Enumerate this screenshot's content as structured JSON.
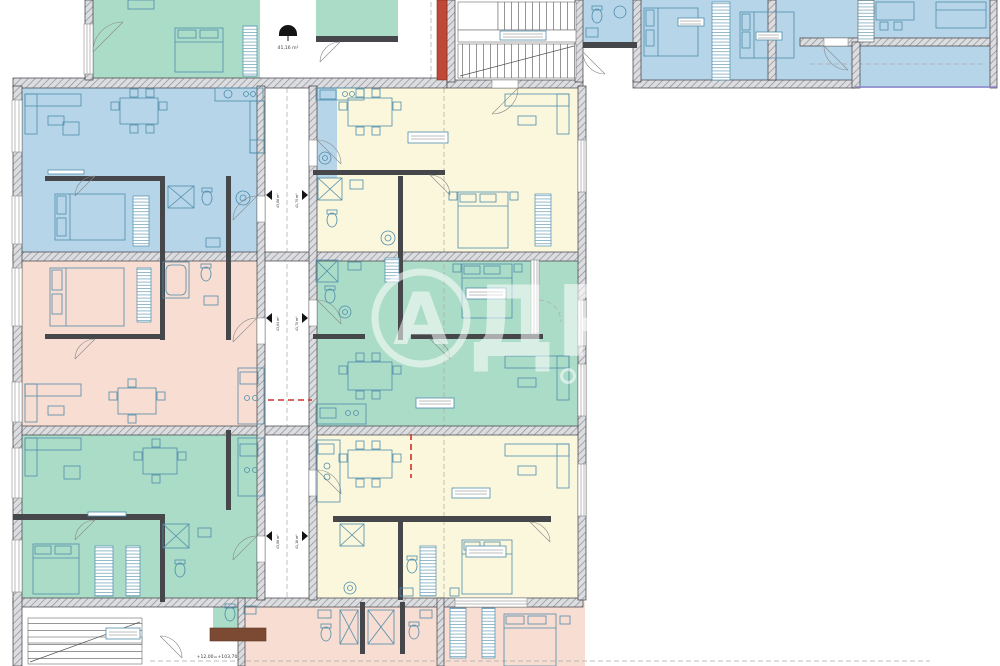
{
  "colors": {
    "green": "#abdcc7",
    "blue": "#b6d5e9",
    "yellow": "#faf7dc",
    "pink": "#f8ddd3",
    "part": "#46474b",
    "walledge": "#3c3d40",
    "furn": "#4f8dab",
    "red": "#bf4936",
    "brown": "#7c4a33",
    "dashred": "#d03028",
    "purple": "#9184c8",
    "dash": "#a9a9a9",
    "text": "#3a3a3a",
    "watermark": "#ffffff"
  },
  "watermark": {
    "logo_letter": "А",
    "letters": "ДР"
  },
  "labels": {
    "elevation_line": "+12,00=+103,70",
    "entrance_area": "41,16 m²",
    "apartment_markers": [
      {
        "left": "43,86 m²",
        "right": "41,70 m²"
      },
      {
        "left": "43,84 m²",
        "right": "41,70 m²"
      },
      {
        "left": "43,86 m²",
        "right": "41,16 m²"
      }
    ]
  },
  "icons": {
    "area_marker": "umbrella-semicircle",
    "stair": "parallel-treads",
    "wardrobe": "ladder-hatch",
    "shower": "crossed-box"
  }
}
